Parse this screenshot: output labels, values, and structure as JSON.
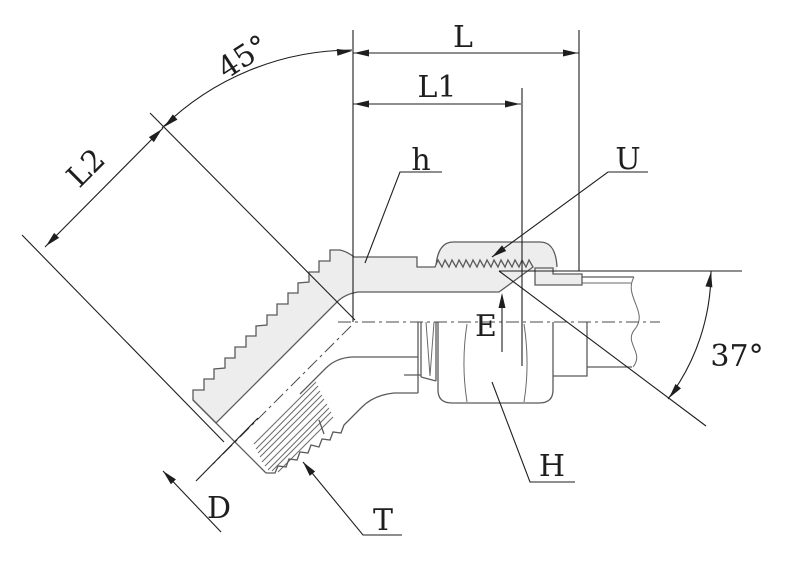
{
  "drawing": {
    "labels": {
      "bend_angle": "45°",
      "overall_length": "L",
      "length_l1": "L1",
      "length_l2": "L2",
      "body_flat": "h",
      "sleeve": "U",
      "thread_engagement": "E",
      "flare_angle": "37°",
      "thread_diameter": "D",
      "thread": "T",
      "hex_nut": "H"
    },
    "colors": {
      "outline": "#5b5b5b",
      "dimension": "#1e1e1e",
      "section_fill": "#ededed",
      "centerline": "#4a4a4a",
      "background": "#ffffff"
    }
  }
}
